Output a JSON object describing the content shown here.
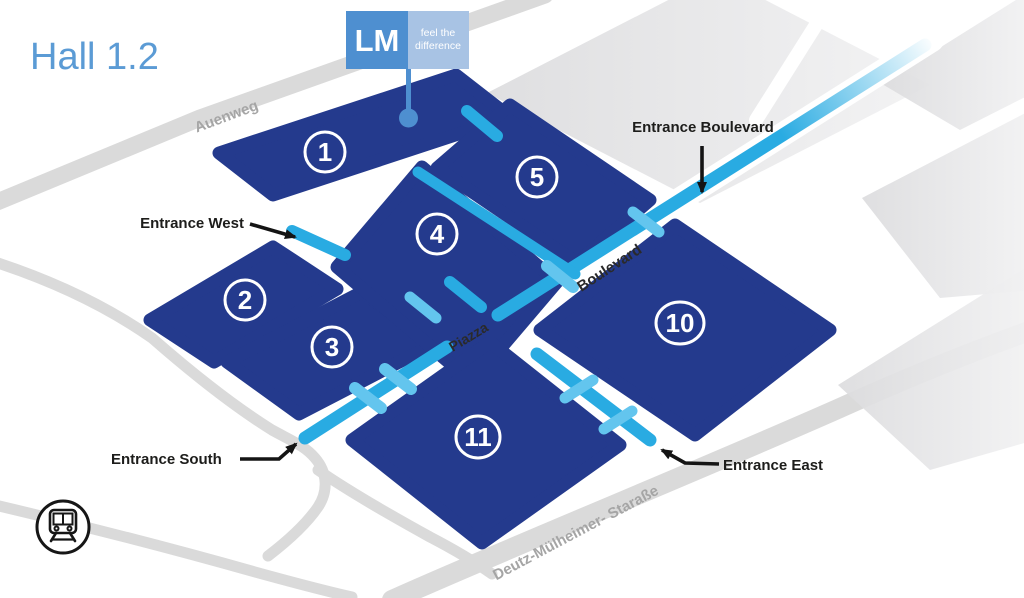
{
  "title": "Hall 1.2",
  "logo": {
    "abbr": "LM",
    "tagline_line1": "feel the",
    "tagline_line2": "difference"
  },
  "halls": [
    {
      "number": "1"
    },
    {
      "number": "2"
    },
    {
      "number": "3"
    },
    {
      "number": "4"
    },
    {
      "number": "5"
    },
    {
      "number": "10"
    },
    {
      "number": "11"
    }
  ],
  "entrances": {
    "west": "Entrance West",
    "boulevard": "Entrance Boulevard",
    "south": "Entrance South",
    "east": "Entrance East"
  },
  "streets": {
    "auenweg": "Auenweg",
    "boulevard": "Boulevard",
    "piazza": "Piazza",
    "deutz": "Deutz-Mülheimer- Staraße"
  },
  "colors": {
    "hall": "#243a8d",
    "path": "#29abe2",
    "path_light": "#63c5ee",
    "road": "#dadada",
    "title_blue": "#5b9bd5",
    "logo_primary": "#4e8fd0",
    "logo_secondary": "#a8c3e4",
    "label_dark": "#1d1d1b",
    "street_gray": "#a5a5a5"
  }
}
